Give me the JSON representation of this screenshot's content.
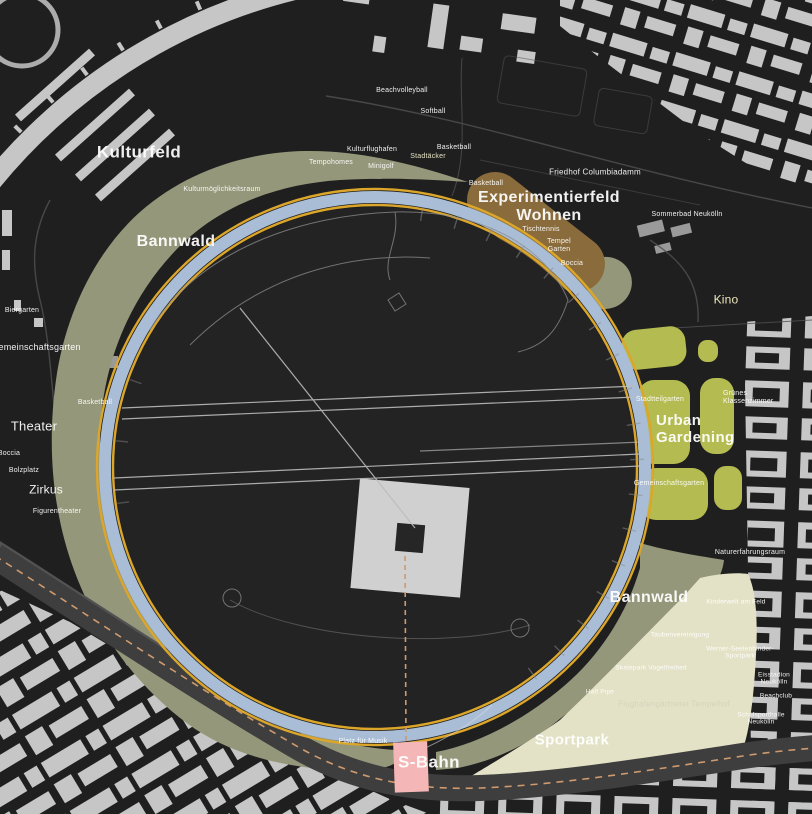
{
  "colors": {
    "background": "#1f1f1f",
    "building": "#c6c6c6",
    "building_dim": "#9a9a9a",
    "olive": "#95977a",
    "brown": "#8a6c3c",
    "garden_green": "#b4bb50",
    "beige": "#e3e2c6",
    "ring_blue": "#a9bdd6",
    "gold": "#dca62a",
    "pink": "#f4b6b6",
    "road": "#3e3e3e",
    "road_dash": "#cf9a6e",
    "runway": "#bcbcbc",
    "path_line": "#8e8e8e",
    "street_faint": "#525252",
    "field_interior": "#232323",
    "plaza": "#d0d0d0",
    "plaza_hole": "#262626",
    "label_white": "#f2f2f2",
    "kino_text": "#ece7bb",
    "cream_text": "#e6e2c6",
    "muted_beige_text": "#d6d3bc"
  },
  "map": {
    "labels": [
      {
        "name": "kulturfeld",
        "text": "Kulturfeld",
        "x": 139,
        "y": 152,
        "size": 17,
        "bold": true
      },
      {
        "name": "bannwald-nw",
        "text": "Bannwald",
        "x": 176,
        "y": 242,
        "size": 16,
        "bold": true
      },
      {
        "name": "experimentierfeld-wohnen",
        "text": "Experimentierfeld\nWohnen",
        "x": 549,
        "y": 207,
        "size": 16,
        "bold": true
      },
      {
        "name": "urban-gardening",
        "text": "Urban\nGardening",
        "x": 656,
        "y": 430,
        "size": 15,
        "bold": true,
        "align": "left"
      },
      {
        "name": "bannwald-se",
        "text": "Bannwald",
        "x": 649,
        "y": 598,
        "size": 16,
        "bold": true
      },
      {
        "name": "sportpark",
        "text": "Sportpark",
        "x": 572,
        "y": 741,
        "size": 15,
        "bold": true
      },
      {
        "name": "s-bahn",
        "text": "S-Bahn",
        "x": 429,
        "y": 762,
        "size": 17,
        "bold": true
      },
      {
        "name": "theater",
        "text": "Theater",
        "x": 34,
        "y": 427,
        "size": 13
      },
      {
        "name": "zirkus",
        "text": "Zirkus",
        "x": 46,
        "y": 490,
        "size": 12
      },
      {
        "name": "kino",
        "text": "Kino",
        "x": 726,
        "y": 300,
        "size": 12,
        "color": "#ece7bb"
      },
      {
        "name": "kulturmoeglichkeitsraum",
        "text": "Kulturmöglichkeitsraum",
        "x": 222,
        "y": 190,
        "size": 7
      },
      {
        "name": "tempohomes",
        "text": "Tempohomes",
        "x": 331,
        "y": 163,
        "size": 7
      },
      {
        "name": "kulturflughafen",
        "text": "Kulturflughafen",
        "x": 372,
        "y": 150,
        "size": 7
      },
      {
        "name": "minigolf",
        "text": "Minigolf",
        "x": 381,
        "y": 167,
        "size": 7
      },
      {
        "name": "stadtaecker",
        "text": "Stadtäcker",
        "x": 428,
        "y": 157,
        "size": 7,
        "color": "#e6e2c6"
      },
      {
        "name": "beachvolleyball",
        "text": "Beachvolleyball",
        "x": 402,
        "y": 91,
        "size": 7
      },
      {
        "name": "softball",
        "text": "Softball",
        "x": 433,
        "y": 112,
        "size": 7
      },
      {
        "name": "basketball-n",
        "text": "Basketball",
        "x": 454,
        "y": 148,
        "size": 7
      },
      {
        "name": "basketball-ne",
        "text": "Basketball",
        "x": 486,
        "y": 184,
        "size": 7
      },
      {
        "name": "friedhof-columbiadamm",
        "text": "Friedhof Columbiadamm",
        "x": 595,
        "y": 173,
        "size": 8
      },
      {
        "name": "sommerbad-neukoelln",
        "text": "Sommerbad Neukölln",
        "x": 687,
        "y": 215,
        "size": 7
      },
      {
        "name": "tischtennis",
        "text": "Tischtennis",
        "x": 541,
        "y": 230,
        "size": 7
      },
      {
        "name": "tempel-garten",
        "text": "Tempel\nGarten",
        "x": 559,
        "y": 246,
        "size": 7
      },
      {
        "name": "boccia-ne",
        "text": "Boccia",
        "x": 572,
        "y": 264,
        "size": 7
      },
      {
        "name": "biergarten",
        "text": "Biergarten",
        "x": 22,
        "y": 311,
        "size": 7
      },
      {
        "name": "gemeinschaftsgarten-w",
        "text": "Gemeinschaftsgarten",
        "x": 36,
        "y": 347,
        "size": 9
      },
      {
        "name": "basketball-w",
        "text": "Basketball",
        "x": 95,
        "y": 403,
        "size": 7
      },
      {
        "name": "boccia-w",
        "text": "Boccia",
        "x": 9,
        "y": 454,
        "size": 7
      },
      {
        "name": "bolzplatz",
        "text": "Bolzplatz",
        "x": 24,
        "y": 471,
        "size": 7
      },
      {
        "name": "figurentheater",
        "text": "Figurentheater",
        "x": 57,
        "y": 512,
        "size": 7
      },
      {
        "name": "stadtteilgarten",
        "text": "Stadtteilgarten",
        "x": 660,
        "y": 400,
        "size": 7
      },
      {
        "name": "gruenes-klassenzimmer",
        "text": "Grünes\nKlassenzimmer",
        "x": 723,
        "y": 398,
        "size": 7,
        "align": "left"
      },
      {
        "name": "gemeinschaftsgarten-ug",
        "text": "Gemeinschaftsgarten",
        "x": 669,
        "y": 484,
        "size": 7
      },
      {
        "name": "naturerfahrungsraum",
        "text": "Naturerfahrungsraum",
        "x": 750,
        "y": 553,
        "size": 7
      },
      {
        "name": "kinderwelt-am-feld",
        "text": "Kinderwelt am Feld",
        "x": 736,
        "y": 602,
        "size": 6.5
      },
      {
        "name": "taubenvereinigung",
        "text": "Taubenvereinigung",
        "x": 680,
        "y": 635,
        "size": 6.5
      },
      {
        "name": "werner-seelenbinder-sportpark",
        "text": "Werner-Seelenbinder-Sportpark",
        "x": 740,
        "y": 653,
        "size": 6.5
      },
      {
        "name": "skatepark-vogelfreiheit",
        "text": "Skatepark Vogelfreiheit",
        "x": 651,
        "y": 668,
        "size": 6.5
      },
      {
        "name": "eisstadion-neukoelln",
        "text": "Eisstadion Neukölln",
        "x": 774,
        "y": 679,
        "size": 6.5
      },
      {
        "name": "half-pipe",
        "text": "Half Pipe",
        "x": 600,
        "y": 692,
        "size": 6.5
      },
      {
        "name": "beachclub",
        "text": "Beachclub",
        "x": 776,
        "y": 696,
        "size": 6.5
      },
      {
        "name": "flughafengaertnerei-tempelhof",
        "text": "Flughafengärtnerei Tempelhof",
        "x": 674,
        "y": 705,
        "size": 8,
        "color": "#d6d3bc"
      },
      {
        "name": "schulsporthalle-neukoelln",
        "text": "Schulsporthalle Neukölln",
        "x": 761,
        "y": 719,
        "size": 6.5
      },
      {
        "name": "platz-fuer-musik",
        "text": "Platz für Musik",
        "x": 363,
        "y": 742,
        "size": 7
      }
    ]
  }
}
